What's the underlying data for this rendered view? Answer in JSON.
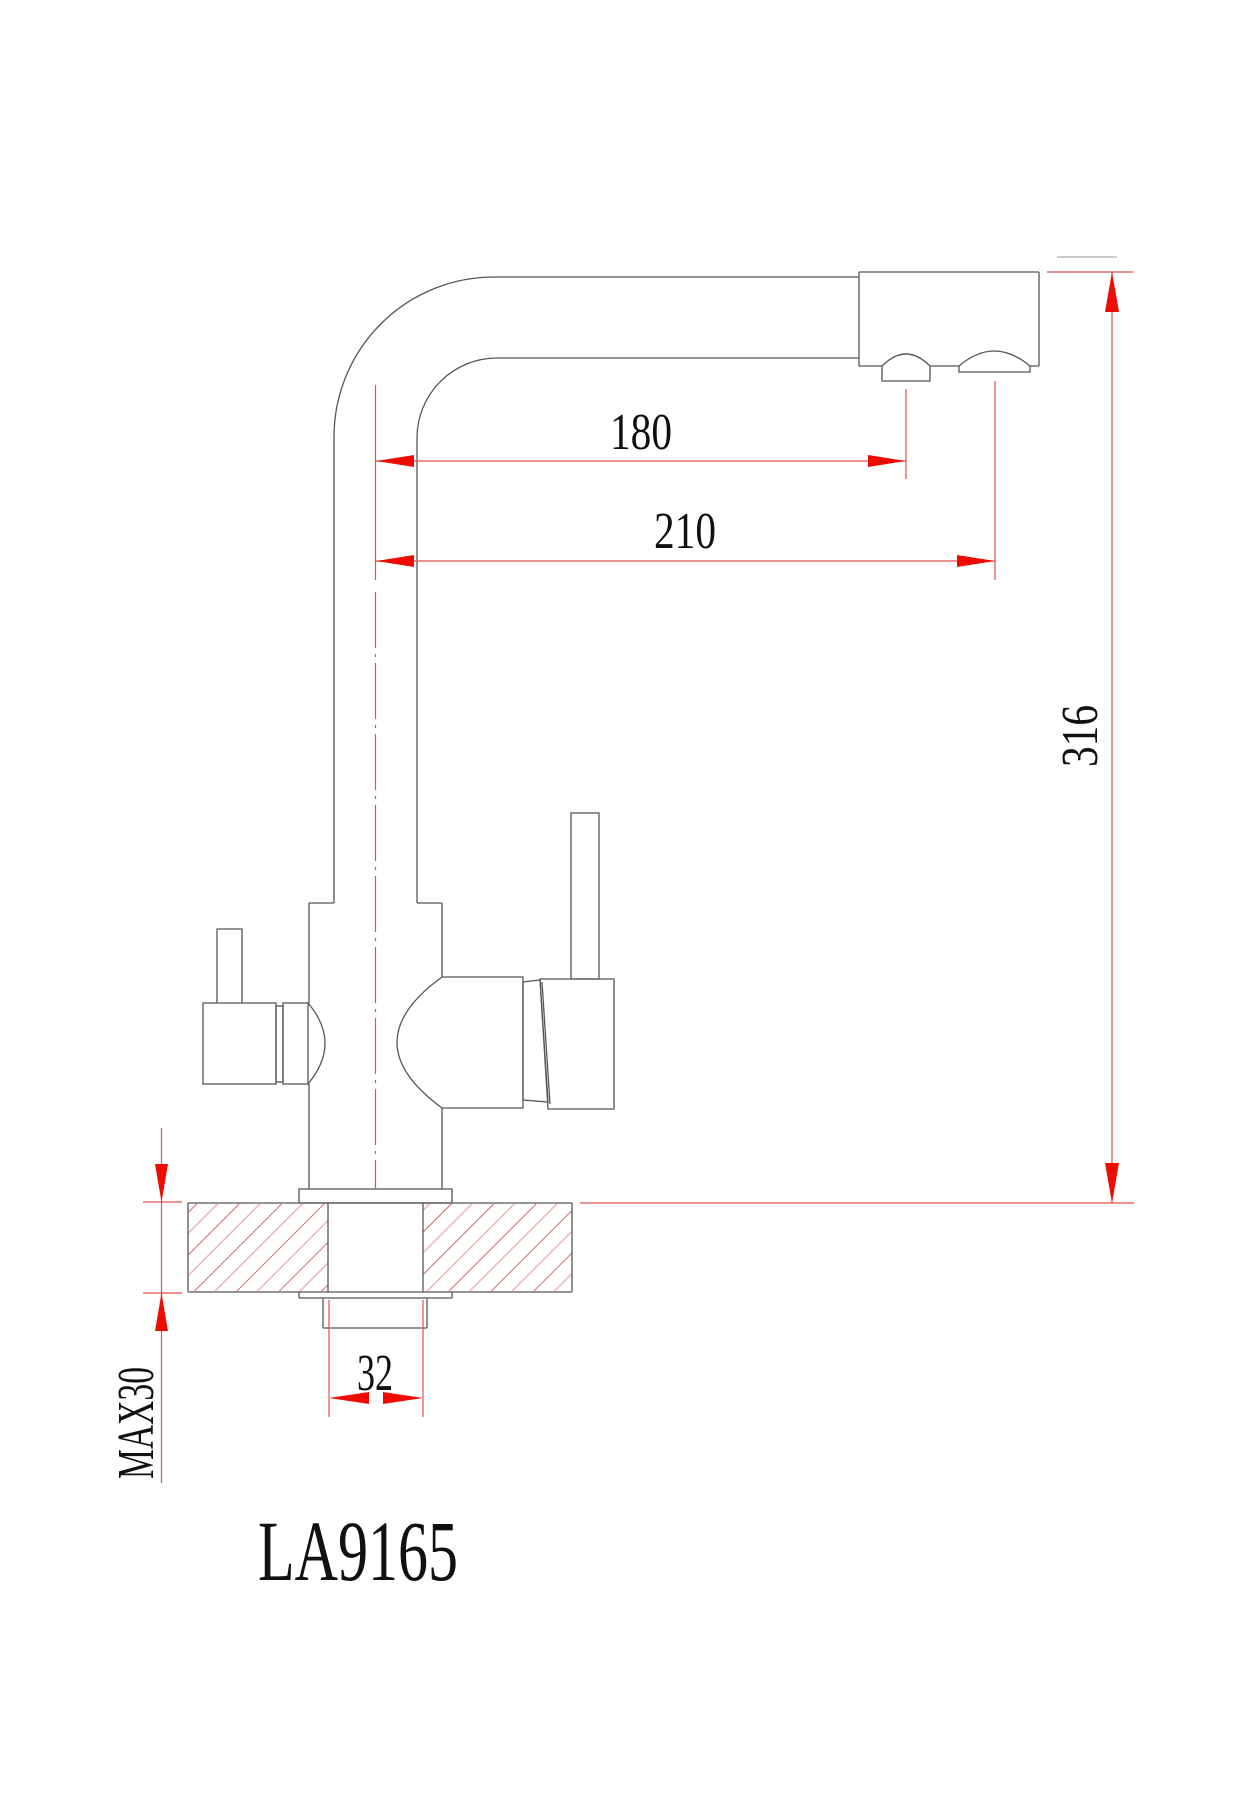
{
  "drawing": {
    "model": "LA9165",
    "type_note": "kitchen-faucet-dimension-drawing",
    "dimensions": {
      "reach_filtered": "180",
      "reach_main": "210",
      "total_height": "316",
      "shank_width": "32",
      "max_counter_thickness": "MAX30"
    },
    "colors": {
      "outline": "#565656",
      "dimension_line": "#e25050",
      "arrow": "#ee0b00",
      "text": "#111111",
      "hatch_dark": "#c23b3b",
      "hatch_light": "#e9a6a6"
    }
  }
}
